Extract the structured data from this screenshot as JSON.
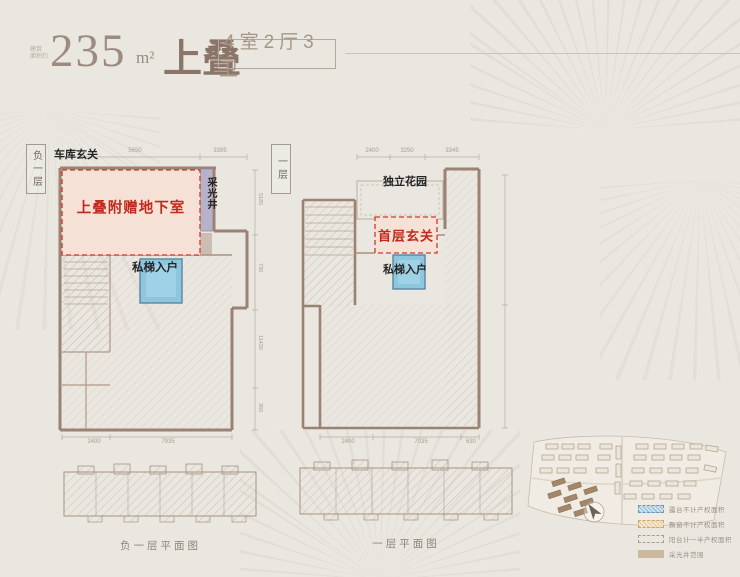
{
  "header": {
    "area_prefix_line1": "建筑",
    "area_prefix_line2": "面积约",
    "area_value": "235",
    "area_unit": "m²",
    "product_name": "上叠",
    "layout_badge": "4室2厅3卫"
  },
  "basement_plan": {
    "floor_tag": "负一层",
    "garage_entry_label": "车库玄关",
    "bonus_area_label": "上叠附赠地下室",
    "light_well_label": "采光井",
    "private_elevator_label": "私梯入户",
    "dim_top_1": "5650",
    "dim_top_2": "3395",
    "dim_bottom_1": "2400",
    "dim_bottom_2": "7935",
    "dim_right_1": "5185",
    "dim_right_2": "730",
    "dim_right_3": "11430",
    "dim_right_4": "360",
    "caption": "负一层平面图"
  },
  "first_floor_plan": {
    "floor_tag": "一层",
    "garden_label": "独立花园",
    "entry_label": "首层玄关",
    "private_elevator_label": "私梯入户",
    "dim_top_1": "2400",
    "dim_top_2": "3250",
    "dim_top_3": "3345",
    "dim_bottom_1": "2400",
    "dim_bottom_2": "7035",
    "dim_bottom_3": "630",
    "caption": "一层平面图"
  },
  "site_plan": {
    "legend": [
      {
        "swatch": "blue-hatch",
        "label": "露台不计产权面积"
      },
      {
        "swatch": "tan-hatch",
        "label": "飘窗不计产权面积"
      },
      {
        "swatch": "dash-outline",
        "label": "阳台计一半产权面积"
      },
      {
        "swatch": "solid-tan",
        "label": "采光井范围"
      }
    ]
  },
  "colors": {
    "accent_red": "#c02a1c",
    "highlight_pink": "#f6e1d7",
    "elevator_blue": "#8cc7de",
    "light_well_lavender": "#b6b2c9",
    "wall_brown": "#9a8274",
    "title_taupe": "#9c8b80"
  }
}
